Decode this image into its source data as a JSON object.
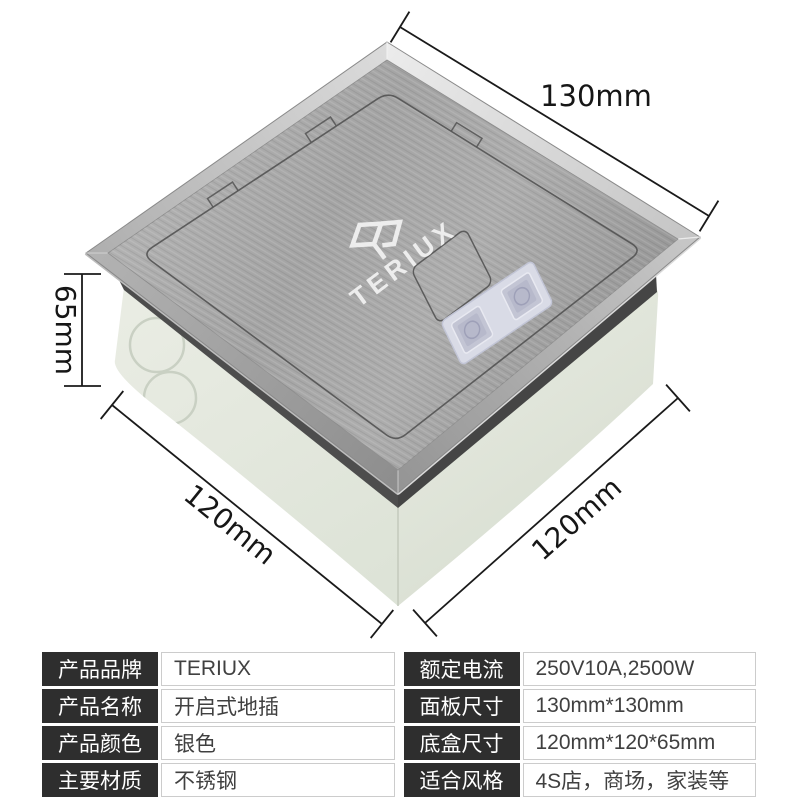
{
  "product": {
    "brand_logo": "TERIUX",
    "logo_icon": "teriux-emblem-icon"
  },
  "dimensions": {
    "panel_width_label": "130mm",
    "height_label": "65mm",
    "depth_left_label": "120mm",
    "depth_right_label": "120mm"
  },
  "spec_table": {
    "left_rows": [
      {
        "label": "产品品牌",
        "value": "TERIUX"
      },
      {
        "label": "产品名称",
        "value": "开启式地插"
      },
      {
        "label": "产品颜色",
        "value": "银色"
      },
      {
        "label": "主要材质",
        "value": "不锈钢"
      }
    ],
    "right_rows": [
      {
        "label": "额定电流",
        "value": "250V10A,2500W"
      },
      {
        "label": "面板尺寸",
        "value": "130mm*130mm"
      },
      {
        "label": "底盒尺寸",
        "value": "120mm*120*65mm"
      },
      {
        "label": "适合风格",
        "value": "4S店，商场，家装等"
      }
    ]
  },
  "colors": {
    "background": "#ffffff",
    "steel_panel": "#a6a6a6",
    "bevel_highlight": "#dedede",
    "box_body": "#e2e7dd",
    "button_accent": "#c3c5d4",
    "dimension_line": "#1a1a1a",
    "table_label_bg": "#2e2e2e",
    "table_label_text": "#ffffff",
    "table_value_text": "#404040",
    "table_border": "#cccccc"
  }
}
